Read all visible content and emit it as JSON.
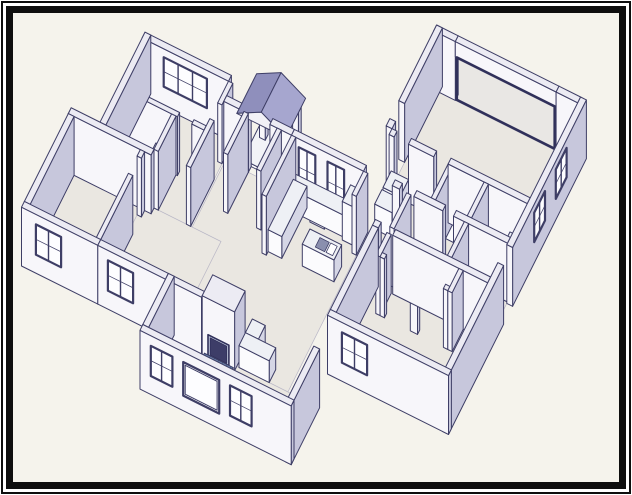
{
  "frame": {
    "outer_border_color": "#0e0e0e",
    "inner_border_color": "#0e0e0e",
    "margin_color": "#ffffff"
  },
  "drawing": {
    "kind": "isometric-house-floor-plan",
    "proj": {
      "k": 8,
      "kz": 8.4,
      "ox": 145,
      "oy": -17
    },
    "palette": {
      "paper": "#f5f3ec",
      "floor": "#eae7e1",
      "wallTop": "#ecebf3",
      "wallS": "#f7f6fa",
      "wallE": "#c7c7dc",
      "cabT": "#eef0f5",
      "cabS": "#fbfbfd",
      "cabE": "#d5d6e5",
      "stroke": "#3e3e66",
      "glass": "#fdfdff",
      "sash": "#3e3e66",
      "roofE": "#a6a6cf",
      "roofW": "#8f8fbc",
      "gable": "#f2f1f7",
      "hearthBase": "#6d84ab",
      "hearthLine": "#2f4f7c",
      "fireboxFill": "#bac1d7",
      "fireboxInner": "#3d3d68",
      "openingFrame": "#30305a",
      "fixT": "#f2f3f7",
      "fixS": "#fcfcfe",
      "fixE": "#dcdde9"
    },
    "floors": [
      {
        "n": "garage-floor",
        "r": [
          38.8,
          -4.2,
          58,
          9
        ]
      },
      {
        "n": "suite-floor",
        "r": [
          38.8,
          9.8,
          58,
          20.8
        ]
      },
      {
        "n": "bedroom3-floor",
        "r": [
          42.8,
          20.8,
          58,
          32.5
        ]
      },
      {
        "n": "center-hall-kitchen-floor",
        "r": [
          18.8,
          15.3,
          38.6,
          37.5
        ]
      },
      {
        "n": "bedroom1-bath-floor",
        "r": [
          6.8,
          12.8,
          18.6,
          24.5
        ]
      },
      {
        "n": "bedroom2-floor",
        "r": [
          2.8,
          25.3,
          12.6,
          37.5
        ]
      },
      {
        "n": "dining-floor",
        "r": [
          12,
          24.5,
          22.8,
          37.5
        ]
      },
      {
        "n": "living-room-floor",
        "r": [
          22.8,
          37.5,
          42.2,
          44.6
        ]
      },
      {
        "n": "porch-slab",
        "r": [
          20.8,
          9.6,
          27,
          14.5
        ],
        "z": [
          0,
          0.35
        ]
      }
    ],
    "shapes": [
      {
        "n": "bedroom1-north-wall",
        "t": "b",
        "r": [
          6,
          12,
          18,
          12.8
        ]
      },
      {
        "n": "bedroom1-window",
        "t": "winS",
        "y": 12.8,
        "x": [
          9,
          15
        ],
        "z": [
          2.5,
          6
        ],
        "p": 3,
        "k": 19.8
      },
      {
        "n": "porch-post-west",
        "t": "b",
        "r": [
          21.3,
          10,
          22.1,
          10.8
        ],
        "z": [
          0,
          5.3
        ]
      },
      {
        "n": "porch-post-east",
        "t": "b",
        "r": [
          25.9,
          10,
          26.7,
          10.8
        ],
        "z": [
          0,
          5.3
        ]
      },
      {
        "n": "garage-north-wall-west",
        "t": "b",
        "r": [
          38,
          -5,
          41,
          -4.2
        ]
      },
      {
        "n": "garage-north-wall-east",
        "t": "b",
        "r": [
          55,
          -5,
          58,
          -4.2
        ]
      },
      {
        "n": "garage-door-header",
        "t": "b",
        "r": [
          41,
          -5,
          55,
          -4.2
        ],
        "z": [
          5.2,
          7
        ]
      },
      {
        "n": "garage-door-opening-frame",
        "t": "frameS",
        "y": -4.2,
        "x": [
          41.2,
          54.8
        ],
        "z": [
          0.15,
          5.2
        ],
        "k": 21.2
      },
      {
        "n": "front-step-wall",
        "t": "b",
        "r": [
          18,
          12.8,
          18.6,
          15.8
        ]
      },
      {
        "n": "garage-west-wall",
        "t": "b",
        "r": [
          38,
          -5,
          38.8,
          5.5
        ]
      },
      {
        "n": "garage-west-wall-stub",
        "t": "b",
        "r": [
          38,
          8,
          38.8,
          9
        ]
      },
      {
        "n": "porch-roof-west-slope",
        "t": "q",
        "pts": [
          [
            23.6,
            9.4,
            7.5
          ],
          [
            23.6,
            14.9,
            7.5
          ],
          [
            20.2,
            14.9,
            5.9
          ],
          [
            20.2,
            9.4,
            5.9
          ]
        ],
        "c": "roofW",
        "k": 25.3
      },
      {
        "n": "porch-roof-east-slope",
        "t": "q",
        "pts": [
          [
            23.6,
            9.4,
            7.5
          ],
          [
            23.6,
            14.9,
            7.5
          ],
          [
            27,
            14.9,
            5.9
          ],
          [
            27,
            9.4,
            5.9
          ]
        ],
        "c": "roofE",
        "k": 25.4
      },
      {
        "n": "porch-roof-gable-end",
        "t": "q",
        "pts": [
          [
            20.2,
            14.9,
            5.9
          ],
          [
            27,
            14.9,
            5.9
          ],
          [
            23.6,
            14.9,
            7.5
          ]
        ],
        "c": "gable",
        "k": 25.5
      },
      {
        "n": "bedroom1-west-wall",
        "t": "b",
        "r": [
          6,
          12,
          6.8,
          24.5
        ]
      },
      {
        "n": "bedroom1-south-wall-a",
        "t": "b",
        "r": [
          6.8,
          19,
          14.3,
          19.6
        ]
      },
      {
        "n": "bedroom1-south-wall-b",
        "t": "b",
        "r": [
          16.3,
          19,
          18,
          19.6
        ]
      },
      {
        "n": "bath1-tub",
        "t": "tub",
        "r": [
          6.8,
          20,
          8.7,
          24.3
        ],
        "z": [
          0,
          1.8
        ]
      },
      {
        "n": "bath1-vanity",
        "t": "b",
        "r": [
          11.3,
          19.6,
          13.5,
          21.5
        ],
        "z": [
          0,
          2.6
        ],
        "c": "cab"
      },
      {
        "n": "bath1-sink",
        "t": "el",
        "c0": [
          12.4,
          20.5
        ],
        "rr": [
          0.55,
          0.5
        ],
        "z": 2.6,
        "k": 25.5
      },
      {
        "n": "bath1-toilet-bowl",
        "t": "el",
        "c0": [
          9.8,
          23.1
        ],
        "rr": [
          0.72,
          0.88
        ],
        "z": 1.1
      },
      {
        "n": "bath1-toilet-tank",
        "t": "b",
        "r": [
          9.1,
          23.8,
          10.5,
          24.5
        ],
        "z": [
          0,
          2.3
        ],
        "c": "fix"
      },
      {
        "n": "bath1-closet-wall",
        "t": "b",
        "r": [
          13.5,
          19.6,
          14.1,
          24.5
        ]
      },
      {
        "n": "bath1-south-wall",
        "t": "b",
        "r": [
          2,
          24.5,
          13.5,
          25.3
        ]
      },
      {
        "n": "hall-east-wall",
        "t": "b",
        "r": [
          18,
          18,
          18.6,
          24.5
        ]
      },
      {
        "n": "front-wall-west",
        "t": "b",
        "r": [
          18.6,
          14.5,
          22,
          15.3
        ]
      },
      {
        "n": "front-wall-mid",
        "t": "b",
        "r": [
          25,
          14.5,
          28,
          15.3
        ]
      },
      {
        "n": "front-wall-east",
        "t": "b",
        "r": [
          28,
          14.5,
          38,
          15.3
        ]
      },
      {
        "n": "front-window-1",
        "t": "winS",
        "y": 15.3,
        "x": [
          29,
          31.3
        ],
        "z": [
          1.2,
          6
        ],
        "p": 2,
        "k": 31.1
      },
      {
        "n": "front-window-2",
        "t": "winS",
        "y": 15.3,
        "x": [
          33,
          35.3
        ],
        "z": [
          1.2,
          6
        ],
        "p": 2,
        "k": 31.2
      },
      {
        "n": "entry-west-wall",
        "t": "b",
        "r": [
          21.4,
          15.3,
          22,
          21
        ]
      },
      {
        "n": "entry-east-wall",
        "t": "b",
        "r": [
          26,
          15.3,
          26.6,
          21
        ]
      },
      {
        "n": "laundry-appliance-1",
        "t": "b",
        "r": [
          39.2,
          10,
          41.6,
          12.3
        ],
        "z": [
          0,
          3
        ],
        "c": "cab"
      },
      {
        "n": "laundry-appliance-2",
        "t": "b",
        "r": [
          39.2,
          12.6,
          41.6,
          14.6
        ],
        "z": [
          0,
          3
        ],
        "c": "cab"
      },
      {
        "n": "garage-south-wall-a",
        "t": "b",
        "r": [
          38.8,
          9,
          39.5,
          9.8
        ]
      },
      {
        "n": "garage-south-wall-b",
        "t": "b",
        "r": [
          41.5,
          9,
          45,
          9.8
        ]
      },
      {
        "n": "garage-south-wall-c",
        "t": "b",
        "r": [
          47,
          9,
          58,
          9.8
        ]
      },
      {
        "n": "east-wall-north",
        "t": "b",
        "r": [
          58,
          -5,
          58.8,
          15.5
        ]
      },
      {
        "n": "garage-window-1",
        "t": "winE",
        "x": 58.8,
        "y": [
          0.5,
          3.5
        ],
        "z": [
          2.5,
          6
        ],
        "p": 2,
        "k": 40.5
      },
      {
        "n": "garage-window-2",
        "t": "winE",
        "x": 58.8,
        "y": [
          6.5,
          9.5
        ],
        "z": [
          2.5,
          6
        ],
        "p": 2,
        "k": 40.6
      },
      {
        "n": "suite-bath-divider-1",
        "t": "b",
        "r": [
          47,
          9.8,
          47.6,
          14.5
        ]
      },
      {
        "n": "suite-bath-divider-2",
        "t": "b",
        "r": [
          52,
          9.8,
          52.6,
          14.5
        ]
      },
      {
        "n": "toilet-1-tank",
        "t": "b",
        "r": [
          49.3,
          9.8,
          50.7,
          10.6
        ],
        "z": [
          0,
          2.3
        ],
        "c": "fix"
      },
      {
        "n": "toilet-1-bowl",
        "t": "el",
        "c0": [
          50,
          11.5
        ],
        "rr": [
          0.72,
          0.88
        ],
        "z": 1.1
      },
      {
        "n": "vanity-1",
        "t": "b",
        "r": [
          47.6,
          9.8,
          49.1,
          11.7
        ],
        "z": [
          0,
          2.6
        ],
        "c": "cab"
      },
      {
        "n": "toilet-2-tank",
        "t": "b",
        "r": [
          53.6,
          9.8,
          55,
          10.6
        ],
        "z": [
          0,
          2.3
        ],
        "c": "fix"
      },
      {
        "n": "toilet-2-bowl",
        "t": "el",
        "c0": [
          54.3,
          11.5
        ],
        "rr": [
          0.72,
          0.88
        ],
        "z": 1.1
      },
      {
        "n": "vanity-2",
        "t": "b",
        "r": [
          55.6,
          9.8,
          58,
          12
        ],
        "z": [
          0,
          2.6
        ],
        "c": "cab"
      },
      {
        "n": "vanity-2-sink",
        "t": "el",
        "c0": [
          56.8,
          10.9
        ],
        "rr": [
          0.55,
          0.5
        ],
        "z": 2.6,
        "k": 37
      },
      {
        "n": "suite-hall-wall-a",
        "t": "b",
        "r": [
          42,
          14.5,
          43,
          15.3
        ]
      },
      {
        "n": "suite-hall-wall-b",
        "t": "b",
        "r": [
          45,
          14.5,
          49,
          15.3
        ]
      },
      {
        "n": "suite-hall-wall-c",
        "t": "b",
        "r": [
          50.5,
          14.5,
          58,
          15.3
        ]
      },
      {
        "n": "suite-hall-west-wall",
        "t": "b",
        "r": [
          44,
          15.3,
          44.6,
          20
        ]
      },
      {
        "n": "suite-closet-wall",
        "t": "b",
        "r": [
          52,
          15.3,
          52.6,
          20
        ]
      },
      {
        "n": "kitchen-suite-divider",
        "t": "b",
        "r": [
          38,
          15.3,
          38.6,
          18.5
        ]
      },
      {
        "n": "kitchen-west-wall",
        "t": "b",
        "r": [
          28,
          15.3,
          28.6,
          23.5
        ]
      },
      {
        "n": "kitchen-counter-back",
        "t": "b",
        "r": [
          28.6,
          15.3,
          36.2,
          17.2
        ],
        "z": [
          0,
          2.6
        ],
        "c": "cab"
      },
      {
        "n": "kitchen-stove",
        "t": "b",
        "r": [
          31.6,
          15.3,
          33.6,
          17.4
        ],
        "z": [
          0,
          2.75
        ],
        "c": "fix",
        "m": "dark"
      },
      {
        "n": "kitchen-fridge",
        "t": "b",
        "r": [
          36.2,
          15.3,
          38,
          17.6
        ],
        "z": [
          0,
          4.6
        ],
        "c": "cab"
      },
      {
        "n": "kitchen-counter-west",
        "t": "b",
        "r": [
          28.6,
          16,
          30.5,
          23
        ],
        "z": [
          0,
          2.6
        ],
        "c": "cab"
      },
      {
        "n": "kitchen-island",
        "t": "b",
        "r": [
          33.2,
          20.6,
          37.6,
          22.7
        ],
        "z": [
          0,
          2.6
        ],
        "c": "cab",
        "m": "sink"
      },
      {
        "n": "bedroom3-north-wall-a",
        "t": "b",
        "r": [
          42,
          20,
          42.8,
          20.8
        ]
      },
      {
        "n": "bedroom3-north-wall-b",
        "t": "b",
        "r": [
          44.8,
          20,
          58,
          20.8
        ]
      },
      {
        "n": "bedroom3-closet-side-1",
        "t": "b",
        "r": [
          44,
          20.8,
          44.6,
          23.9
        ]
      },
      {
        "n": "bedroom3-closet-stub-1",
        "t": "b",
        "r": [
          44.6,
          23.3,
          45.2,
          23.9
        ]
      },
      {
        "n": "bedroom3-closet-stub-2",
        "t": "b",
        "r": [
          48.8,
          23.3,
          49.8,
          23.9
        ]
      },
      {
        "n": "bedroom3-closet-stub-3",
        "t": "b",
        "r": [
          53.4,
          23.3,
          54,
          23.9
        ]
      },
      {
        "n": "bedroom3-closet-side-2",
        "t": "b",
        "r": [
          54,
          20.8,
          54.6,
          23.9
        ]
      },
      {
        "n": "bedroom3-west-wall",
        "t": "b",
        "r": [
          42,
          20.8,
          42.8,
          32.5
        ]
      },
      {
        "n": "bedroom2-north-wall",
        "t": "b",
        "r": [
          2,
          24.5,
          6.8,
          25.3
        ]
      },
      {
        "n": "bedroom2-east-wall-a",
        "t": "b",
        "r": [
          12,
          25.3,
          12.6,
          26.2
        ]
      },
      {
        "n": "bedroom2-east-wall-b",
        "t": "b",
        "r": [
          12,
          28.6,
          12.6,
          37.5
        ]
      },
      {
        "n": "bedroom2-west-wall",
        "t": "b",
        "r": [
          2,
          25.3,
          2.8,
          37.5
        ]
      },
      {
        "n": "south-wall-west",
        "t": "b",
        "r": [
          2,
          37.5,
          12.6,
          38.3
        ]
      },
      {
        "n": "bedroom2-window",
        "t": "winS",
        "y": 38.3,
        "x": [
          4,
          7.5
        ],
        "z": [
          2.2,
          5.8
        ],
        "p": 2,
        "k": 40.3
      },
      {
        "n": "south-wall-mid",
        "t": "b",
        "r": [
          12.6,
          37.5,
          22,
          38.3
        ]
      },
      {
        "n": "dining-window",
        "t": "winS",
        "y": 38.3,
        "x": [
          14,
          17.5
        ],
        "z": [
          2.2,
          5.8
        ],
        "p": 2,
        "k": 44.5
      },
      {
        "n": "south-wall-fireplace-seg",
        "t": "b",
        "r": [
          22,
          37.5,
          27,
          38.3
        ]
      },
      {
        "n": "fireplace-chimney",
        "t": "b",
        "r": [
          27,
          35.2,
          31.5,
          38.1
        ]
      },
      {
        "n": "fireplace-firebox",
        "t": "firebox",
        "y": 38.1,
        "x": [
          27.8,
          30.7
        ],
        "z": [
          0.25,
          2.7
        ],
        "k": 48.6
      },
      {
        "n": "kitchen-peninsula-return",
        "t": "b",
        "r": [
          31.8,
          33.8,
          33.6,
          35.7
        ],
        "z": [
          0,
          2.6
        ],
        "c": "cab"
      },
      {
        "n": "kitchen-peninsula",
        "t": "b",
        "r": [
          31.8,
          35.7,
          36,
          37.5
        ],
        "z": [
          0,
          2.6
        ],
        "c": "cab"
      },
      {
        "n": "fireplace-hearth",
        "t": "b",
        "r": [
          27.3,
          38.1,
          31.3,
          40.1
        ],
        "z": [
          0,
          0.28
        ],
        "c": "hearth",
        "k": 50.2
      },
      {
        "n": "living-west-wall",
        "t": "b",
        "r": [
          22,
          37.5,
          22.8,
          44.6
        ]
      },
      {
        "n": "east-wall-south",
        "t": "b",
        "r": [
          58,
          18,
          58.8,
          33.3
        ]
      },
      {
        "n": "bedroom3-south-wall",
        "t": "b",
        "r": [
          42,
          32.5,
          58.8,
          33.3
        ],
        "k": 56.5
      },
      {
        "n": "bedroom3-window",
        "t": "winS",
        "y": 33.3,
        "x": [
          44,
          47.5
        ],
        "z": [
          2.2,
          5.8
        ],
        "p": 2,
        "k": 56.6
      },
      {
        "n": "living-south-wall",
        "t": "b",
        "r": [
          22,
          44.6,
          43,
          45.4
        ]
      },
      {
        "n": "living-east-wall",
        "t": "b",
        "r": [
          42.2,
          37.5,
          43,
          45.4
        ],
        "k": 60.1
      },
      {
        "n": "living-window-1",
        "t": "winS",
        "y": 45.4,
        "x": [
          23.5,
          26.5
        ],
        "z": [
          2.2,
          5.8
        ],
        "p": 2,
        "k": 60.3
      },
      {
        "n": "living-picture-window",
        "t": "winS",
        "y": 45.4,
        "x": [
          28,
          33
        ],
        "z": [
          1.8,
          5.8
        ],
        "p": 1,
        "k": 60.35
      },
      {
        "n": "living-window-2",
        "t": "winS",
        "y": 45.4,
        "x": [
          34.5,
          37.5
        ],
        "z": [
          2.2,
          5.8
        ],
        "p": 2,
        "k": 60.4
      }
    ]
  }
}
